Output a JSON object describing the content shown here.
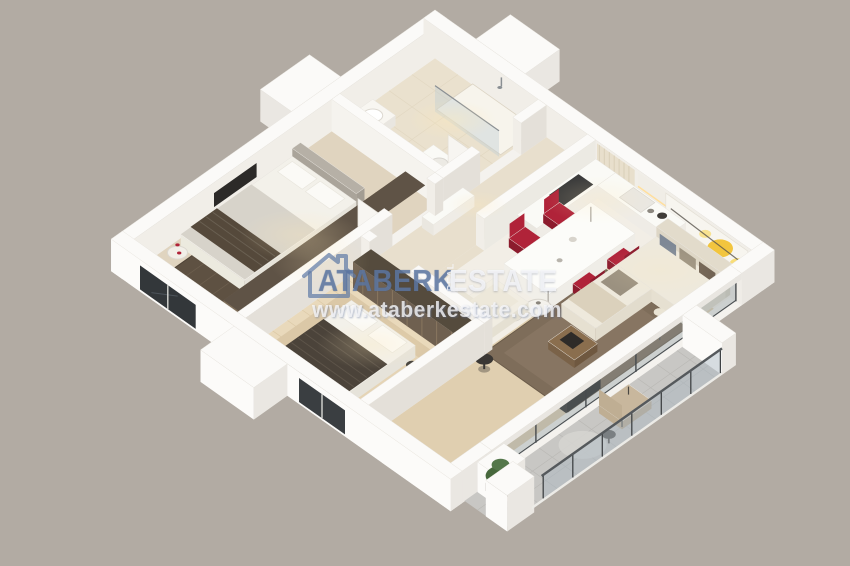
{
  "watermark": {
    "brand": "ATABERK",
    "brand_mid": "REAL",
    "brand_suffix": "ESTATE",
    "url": "www.ataberkestate.com"
  },
  "scene": {
    "type": "3d-isometric-apartment-floor-plan-render",
    "rooms": [
      "bathroom",
      "hallway",
      "bedroom-1",
      "bedroom-2",
      "kitchen-living-room",
      "balcony"
    ]
  },
  "palette": {
    "bg": "#b2aba3",
    "slab": "#f4f2ee",
    "wallTop": "#fbfaf8",
    "wallBright": "#fcfbf9",
    "wallMid": "#eae7e2",
    "wallInner": "#e4e0d9",
    "wallInnerLight": "#f1eee8",
    "floorBath": "#eae1ce",
    "floorHall": "#e8dfcd",
    "floorBed1": "#e0d4bf",
    "floorBed2": "#e9d9bb",
    "floorLiving": "#f2eee6",
    "floorWood": "#e0cfb0",
    "floorBalcony": "#c8c7c4",
    "rugDark": "#5e5142",
    "rugDark2": "#6d5f4e",
    "rugBeige": "#dbc8a7",
    "rugBeigeIn": "#e5d4b5",
    "rugLiving": "#7e6d5a",
    "rugLivingIn": "#8e7c67",
    "bedWhite": "#f3f1ea",
    "bedGray": "#d7d3ca",
    "headboard": "#b6b0a6",
    "throwDark": "#55493b",
    "stripe": "#6a6052",
    "blanket2": "#4b433a",
    "stripe2": "#5d5449",
    "wardrobe": "#7d6d58",
    "wardrobeHi": "#a08d72",
    "wardrobeDk": "#5f5346",
    "wardrobe2": "#6f6050",
    "wardrobe2Hi": "#8d7b62",
    "wardrobe2Dk": "#554b3d",
    "counter": "#fafaf6",
    "counterSide": "#efece6",
    "cooktop": "#3b3b3b",
    "tableWhite": "#fcfcf9",
    "chairRed": "#b02339",
    "chairRedDk": "#8c1b2d",
    "sofa": "#eee9dc",
    "sofaDk": "#e2dbcb",
    "pillowA": "#9b9180",
    "pillowB": "#7e8896",
    "pillowC": "#6f6152",
    "artBg": "#f7f5ef",
    "artY1": "#f2c53e",
    "artY2": "#f8dd78",
    "wood": "#8a6e4e",
    "tvDark": "#2c2a28",
    "glass": "rgba(140,152,158,0.38)",
    "glassFrame": "#474b4e",
    "railGlass": "rgba(168,182,192,0.45)",
    "railFrame": "#3f4244",
    "plant": "#47683c",
    "plantHi": "#54774a",
    "plantDk": "#35512c",
    "chairBeige": "#c8b79d",
    "chairBeigeDk": "#bfae93",
    "mirror": "#cfd6d3",
    "curtain": "#e8dfcc",
    "curtainDk": "#d9cfb8",
    "steel": "#8a8f93",
    "glow": "#ffe9b8",
    "wmBlue": "rgba(97,123,166,0.72)",
    "wmWhite": "rgba(246,247,250,0.84)",
    "wmUrl": "rgba(247,248,250,0.8)"
  }
}
